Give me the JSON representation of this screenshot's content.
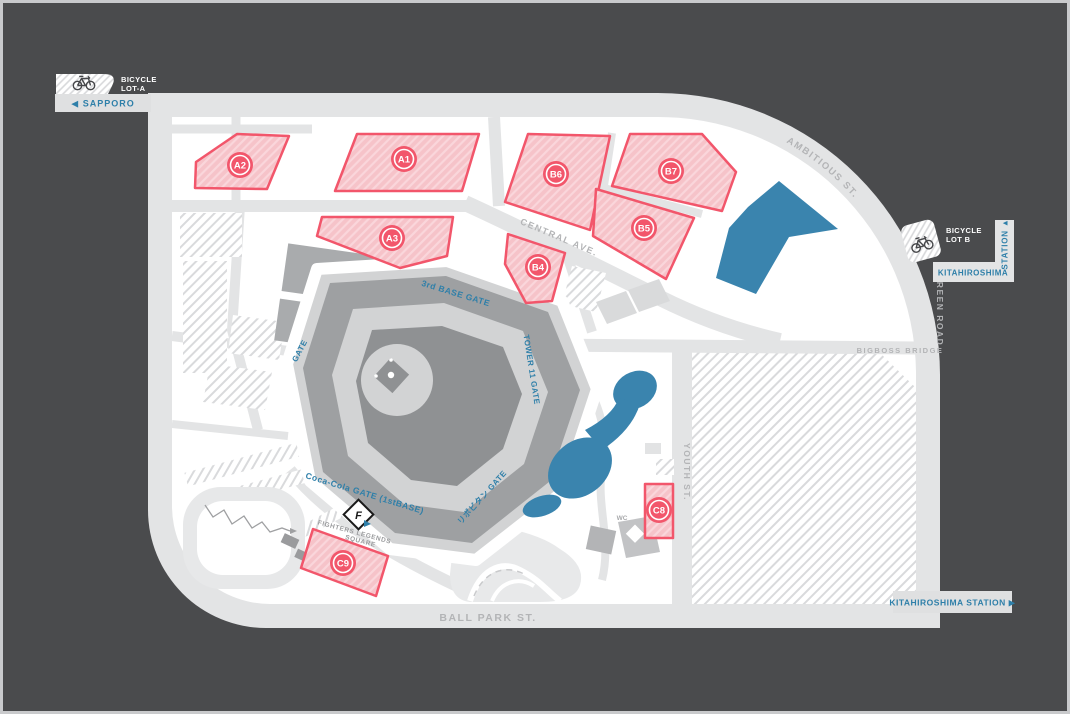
{
  "colors": {
    "background": "#4A4B4D",
    "frame": "#C9CACC",
    "road_gray": "#E3E4E5",
    "block_white": "#FFFFFF",
    "lot_fill": "#F6C3C9",
    "lot_border": "#F2566B",
    "water_blue": "#3A84AE",
    "label_blue": "#2E7FA9",
    "label_gray": "#B3B4B6",
    "stadium_field": "#8F9193",
    "stadium_mid": "#9EA0A2",
    "stadium_light": "#D2D3D4"
  },
  "lots": {
    "a1": "A1",
    "a2": "A2",
    "a3": "A3",
    "b4": "B4",
    "b5": "B5",
    "b6": "B6",
    "b7": "B7",
    "c8": "C8",
    "c9": "C9"
  },
  "bicycle_lot_a": {
    "line1": "BICYCLE",
    "line2": "LOT-A"
  },
  "bicycle_lot_b": {
    "line1": "BICYCLE",
    "line2": "LOT B"
  },
  "stations": {
    "sapporo": "◀ SAPPORO",
    "kitahiroshima_side_vertical": "STATION ▲",
    "kitahiroshima_side_name": "KITAHIROSHIMA",
    "kitahiroshima_bottom": "KITAHIROSHIMA STATION ▶"
  },
  "roads": {
    "central_ave": "CENTRAL AVE.",
    "ambitious_st": "AMBITIOUS ST.",
    "green_road": "GREEN ROAD",
    "bigboss_bridge": "BIGBOSS BRIDGE",
    "youth_st": "YOUTH ST.",
    "ball_park_st": "BALL PARK ST."
  },
  "gates": {
    "third_base": "3rd BASE GATE",
    "west_gate": "GATE",
    "tower_11": "TOWER 11 GATE",
    "coca_cola": "Coca-Cola GATE (1stBASE)",
    "lipovitan": "リポビタン GATE"
  },
  "landmarks": {
    "fighters_legends_line1": "FIGHTERS LEGENDS",
    "fighters_legends_line2": "SQUARE",
    "logo_letter": "F",
    "wc": "WC"
  }
}
